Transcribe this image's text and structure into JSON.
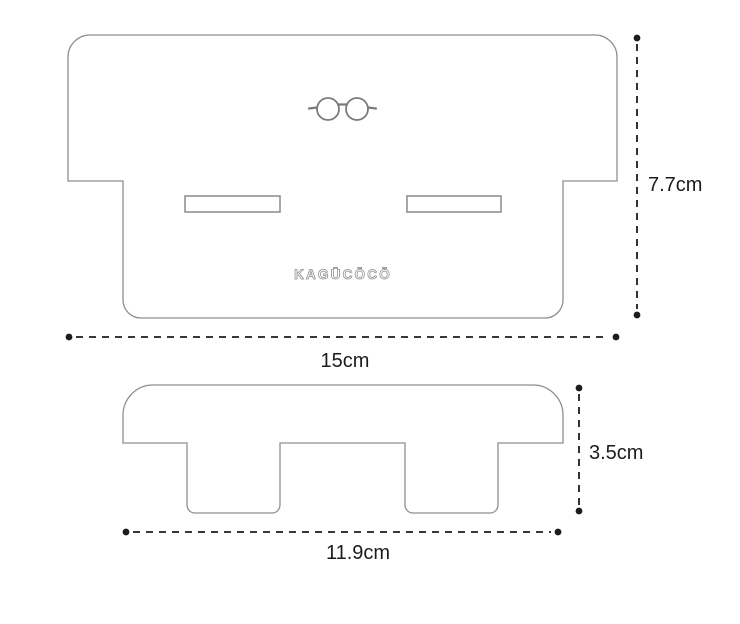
{
  "diagram": {
    "type": "product-dimension-drawing",
    "background_color": "#ffffff",
    "colors": {
      "outline": "#8f8f8f",
      "dimension_line": "#1c1c1c",
      "logo": "#8a8a8a"
    },
    "brand": {
      "logo_text": "KAGŪCŌCŌ"
    },
    "icons": {
      "glasses": "round-glasses-icon"
    },
    "front_view": {
      "name": "front view with logo and two slots",
      "height_label": "7.7cm",
      "width_label": "15cm"
    },
    "side_view": {
      "name": "side profile with two legs",
      "height_label": "3.5cm",
      "width_label": "11.9cm"
    }
  }
}
